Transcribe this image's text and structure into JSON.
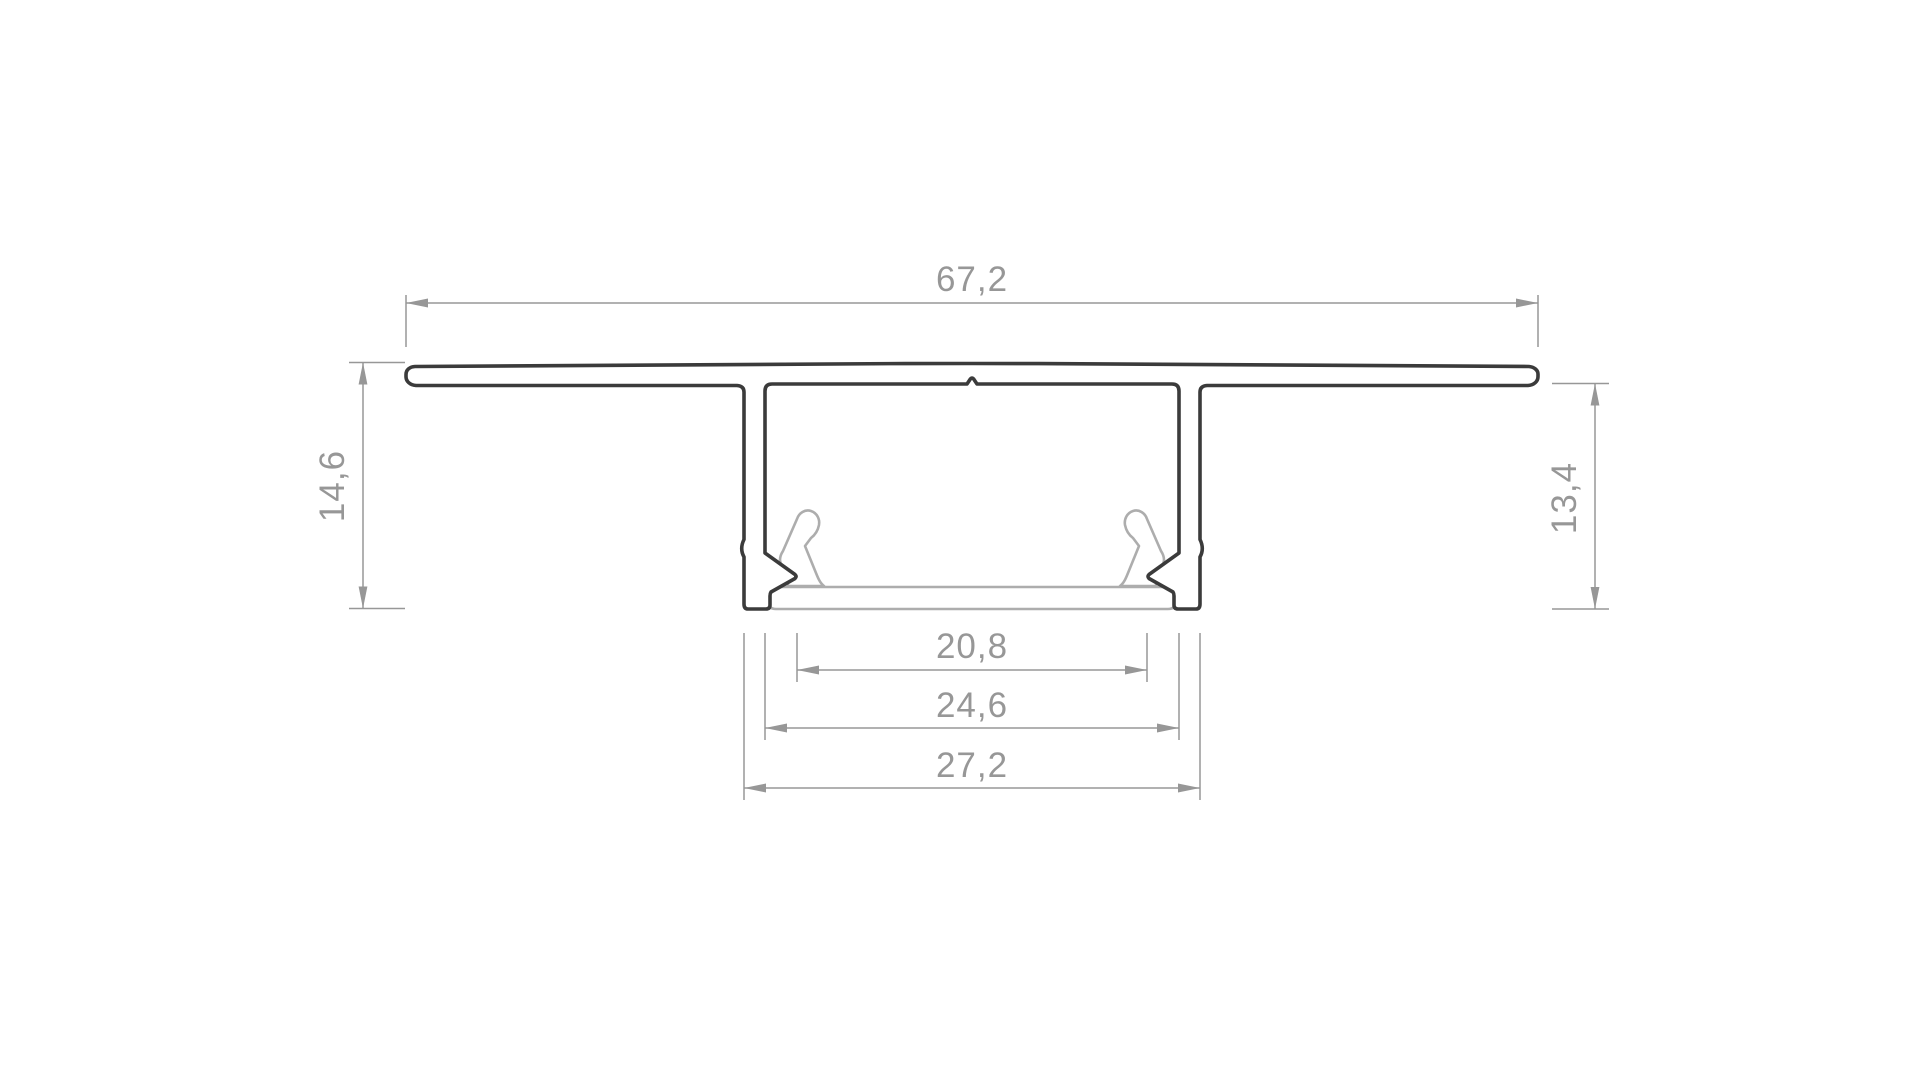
{
  "drawing": {
    "kind": "technical-cross-section",
    "subject": "recessed LED aluminium profile",
    "units": "mm",
    "labels": {
      "top_width": "67,2",
      "left_height": "14,6",
      "right_height": "13,4",
      "bottom_inner_width": "20,8",
      "bottom_middle_width": "24,6",
      "bottom_outer_width": "27,2"
    },
    "colors": {
      "profile_stroke": "#3b3b3b",
      "insert_stroke": "#adadad",
      "dimension_color": "#979797",
      "page_bg": "#ffffff"
    }
  }
}
